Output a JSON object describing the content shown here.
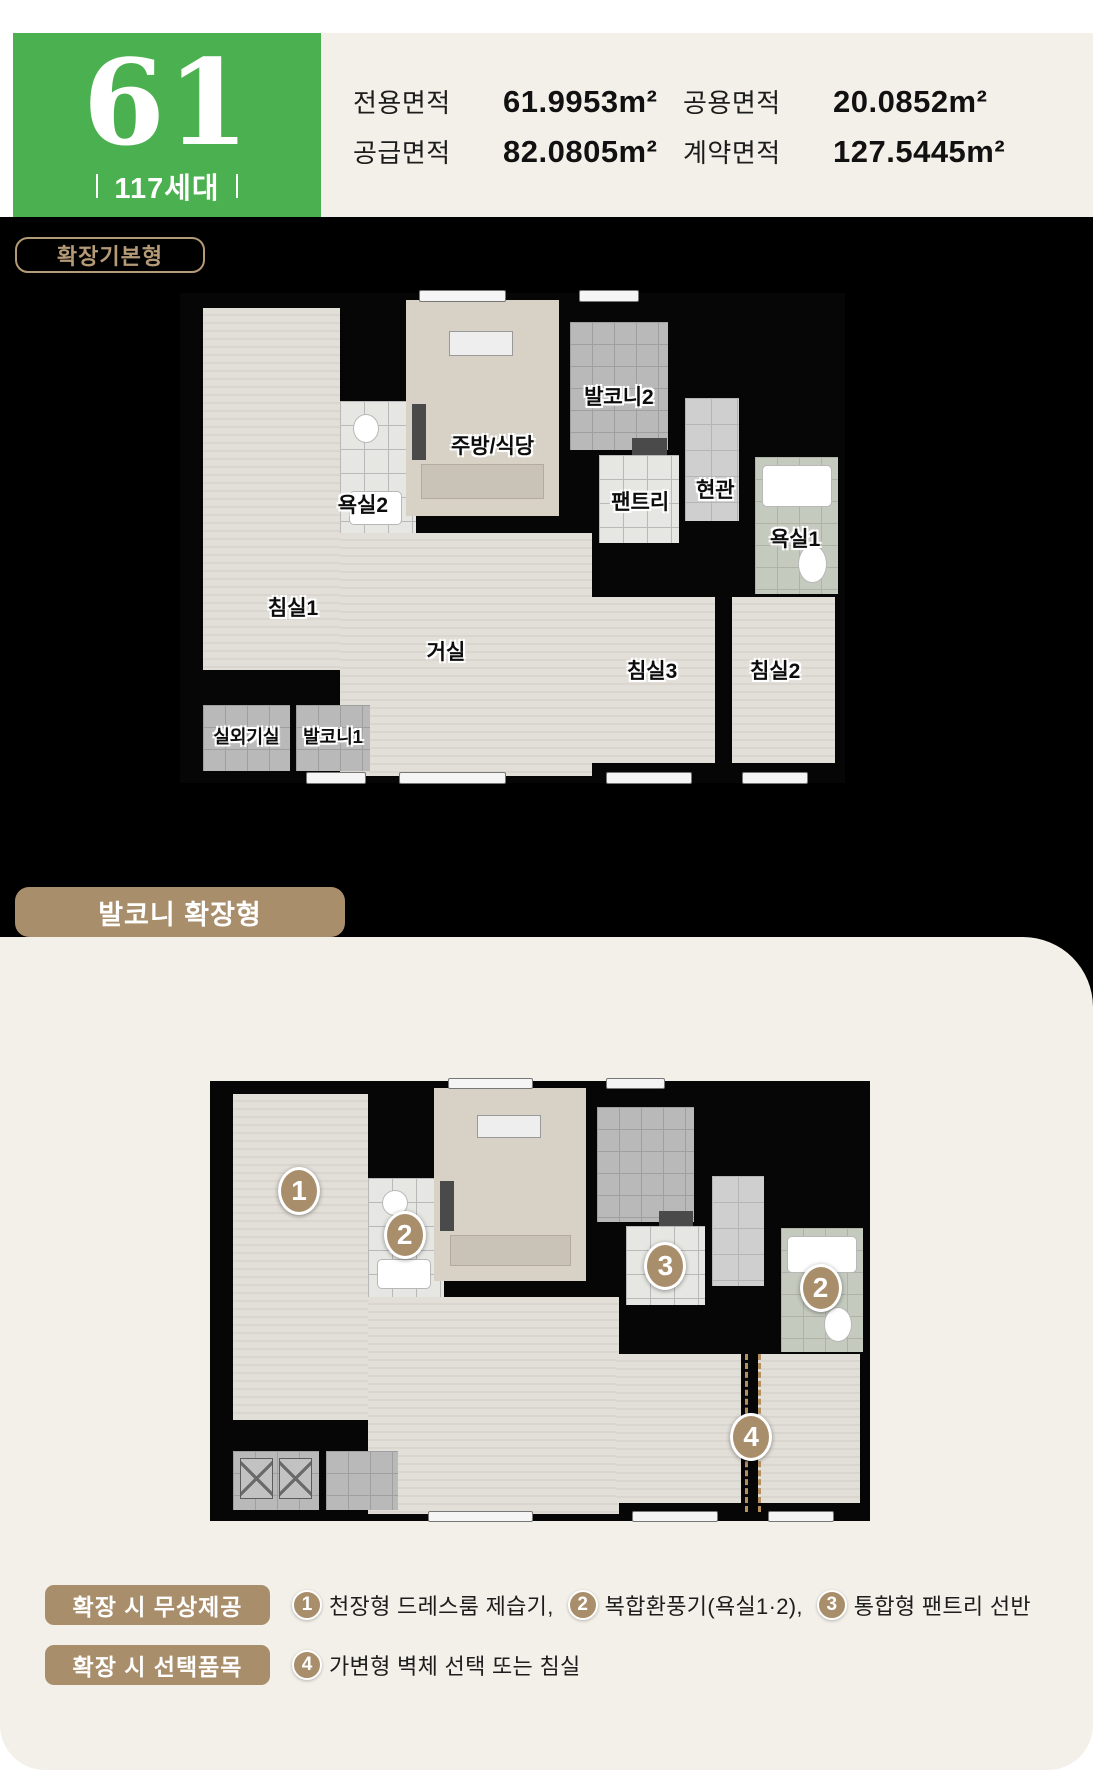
{
  "header": {
    "unit_number": "61",
    "household_count": "117세대",
    "areas": [
      {
        "label": "전용면적",
        "value": "61.9953m²"
      },
      {
        "label": "공용면적",
        "value": "20.0852m²"
      },
      {
        "label": "공급면적",
        "value": "82.0805m²"
      },
      {
        "label": "계약면적",
        "value": "127.5445m²"
      }
    ]
  },
  "plan_basic": {
    "badge": "확장기본형",
    "rooms": {
      "bed1": "침실1",
      "bath2": "욕실2",
      "kitchen": "주방/식당",
      "balcony2": "발코니2",
      "pantry": "팬트리",
      "entry": "현관",
      "bath1": "욕실1",
      "living": "거실",
      "bed3": "침실3",
      "bed2": "침실2",
      "outdoor": "실외기실",
      "balcony1": "발코니1"
    }
  },
  "plan_extended": {
    "badge": "발코니 확장형",
    "markers": {
      "m1": "1",
      "m2a": "2",
      "m3": "3",
      "m2b": "2",
      "m4": "4"
    }
  },
  "legend": {
    "free_row": {
      "badge": "확장 시 무상제공",
      "items": [
        {
          "num": "1",
          "text": "천장형 드레스룸 제습기,"
        },
        {
          "num": "2",
          "text": "복합환풍기(욕실1·2),"
        },
        {
          "num": "3",
          "text": "통합형 팬트리 선반"
        }
      ]
    },
    "option_row": {
      "badge": "확장 시 선택품목",
      "items": [
        {
          "num": "4",
          "text": "가변형 벽체 선택 또는 침실"
        }
      ]
    }
  },
  "colors": {
    "accent_green": "#4bb04f",
    "cream": "#f3f0e9",
    "tan": "#a98e6c",
    "black": "#000000"
  }
}
